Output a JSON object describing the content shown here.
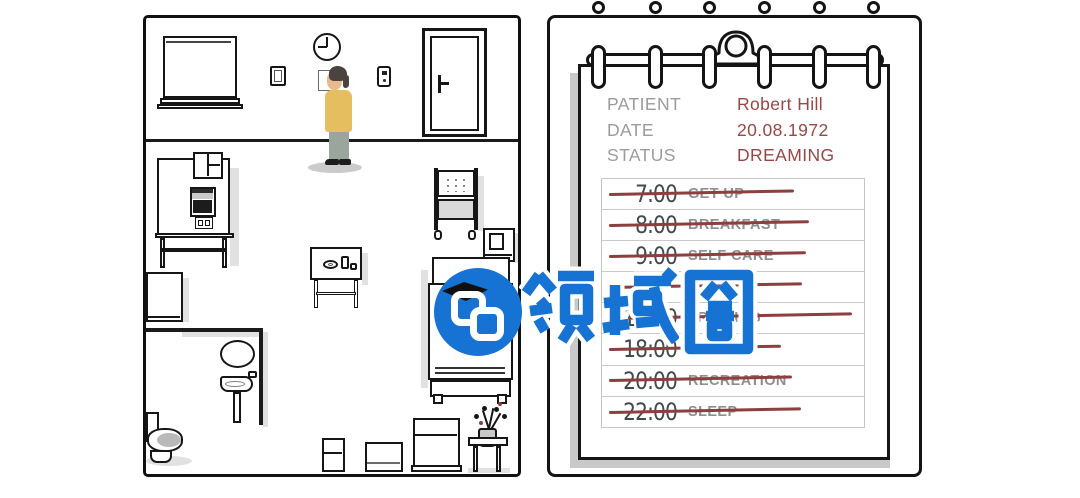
{
  "room": {
    "character": {
      "description": "patient standing figure",
      "shirt_color": "#e5bf5f",
      "pants_color": "#9aa59e",
      "hair_color": "#4a4340"
    },
    "clock_time_shown": "9:00",
    "objects": [
      "window-blind",
      "wall-clock",
      "picture-frame",
      "wall-paper",
      "light-switch",
      "door",
      "medical-machine",
      "fridge-cabinet",
      "bathroom-mirror",
      "pedestal-sink",
      "toilet",
      "side-table",
      "supply-cart",
      "nightstand",
      "bed",
      "storage-boxes",
      "plant-stool"
    ]
  },
  "clipboard": {
    "fields": [
      {
        "label": "PATIENT",
        "value": "Robert Hill"
      },
      {
        "label": "DATE",
        "value": "20.08.1972"
      },
      {
        "label": "STATUS",
        "value": "DREAMING"
      }
    ],
    "schedule": [
      {
        "time": "7:00",
        "activity": "GET UP",
        "struck": true
      },
      {
        "time": "8:00",
        "activity": "BREAKFAST",
        "struck": true
      },
      {
        "time": "9:00",
        "activity": "SELF CARE",
        "struck": true
      },
      {
        "time": "",
        "activity": "",
        "struck": true,
        "hidden_by_watermark": true
      },
      {
        "time": "15:00",
        "activity": "TRAINING",
        "struck": true,
        "partially_hidden_by_watermark": true
      },
      {
        "time": "18:00",
        "activity": "DINNER",
        "struck": true
      },
      {
        "time": "20:00",
        "activity": "RECREATION",
        "struck": true
      },
      {
        "time": "22:00",
        "activity": "SLEEP",
        "struck": true
      }
    ],
    "label_color": "#9b9b9b",
    "value_color": "#9a4646",
    "strike_color": "#8d3e3e"
  },
  "watermark": {
    "text": "领域圈",
    "color": "#1673d3"
  }
}
